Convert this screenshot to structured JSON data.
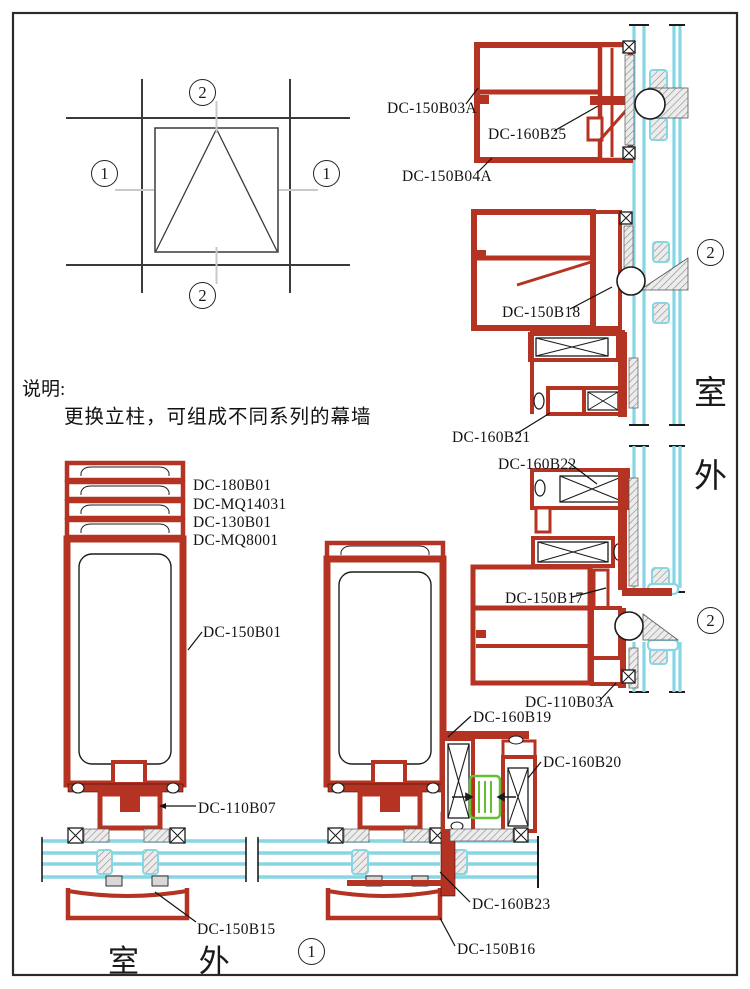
{
  "notes": {
    "heading": "说明:",
    "body": "更换立柱，可组成不同系列的幕墙"
  },
  "side_label": {
    "char1": "室",
    "char2": "外",
    "bottom": "室 外"
  },
  "markers": {
    "schematic_top": "2",
    "schematic_left": "1",
    "schematic_right": "1",
    "schematic_bottom": "2",
    "section_upper": "2",
    "section_lower": "2",
    "section_bottom": "1"
  },
  "part_labels": [
    "DC-150B03A",
    "DC-160B25",
    "DC-150B04A",
    "DC-150B18",
    "DC-160B21",
    "DC-160B22",
    "DC-150B17",
    "DC-110B03A",
    "DC-160B19",
    "DC-160B20",
    "DC-160B23",
    "DC-150B16",
    "DC-150B15",
    "DC-150B01",
    "DC-110B07",
    "DC-180B01",
    "DC-MQ14031",
    "DC-130B01",
    "DC-MQ8001"
  ],
  "colors": {
    "profile_red": "#b43322",
    "glass_cyan": "#86d6e4",
    "gasket_green": "#62c132",
    "hatch_gray": "#909090",
    "line_black": "#1c1c1c"
  }
}
